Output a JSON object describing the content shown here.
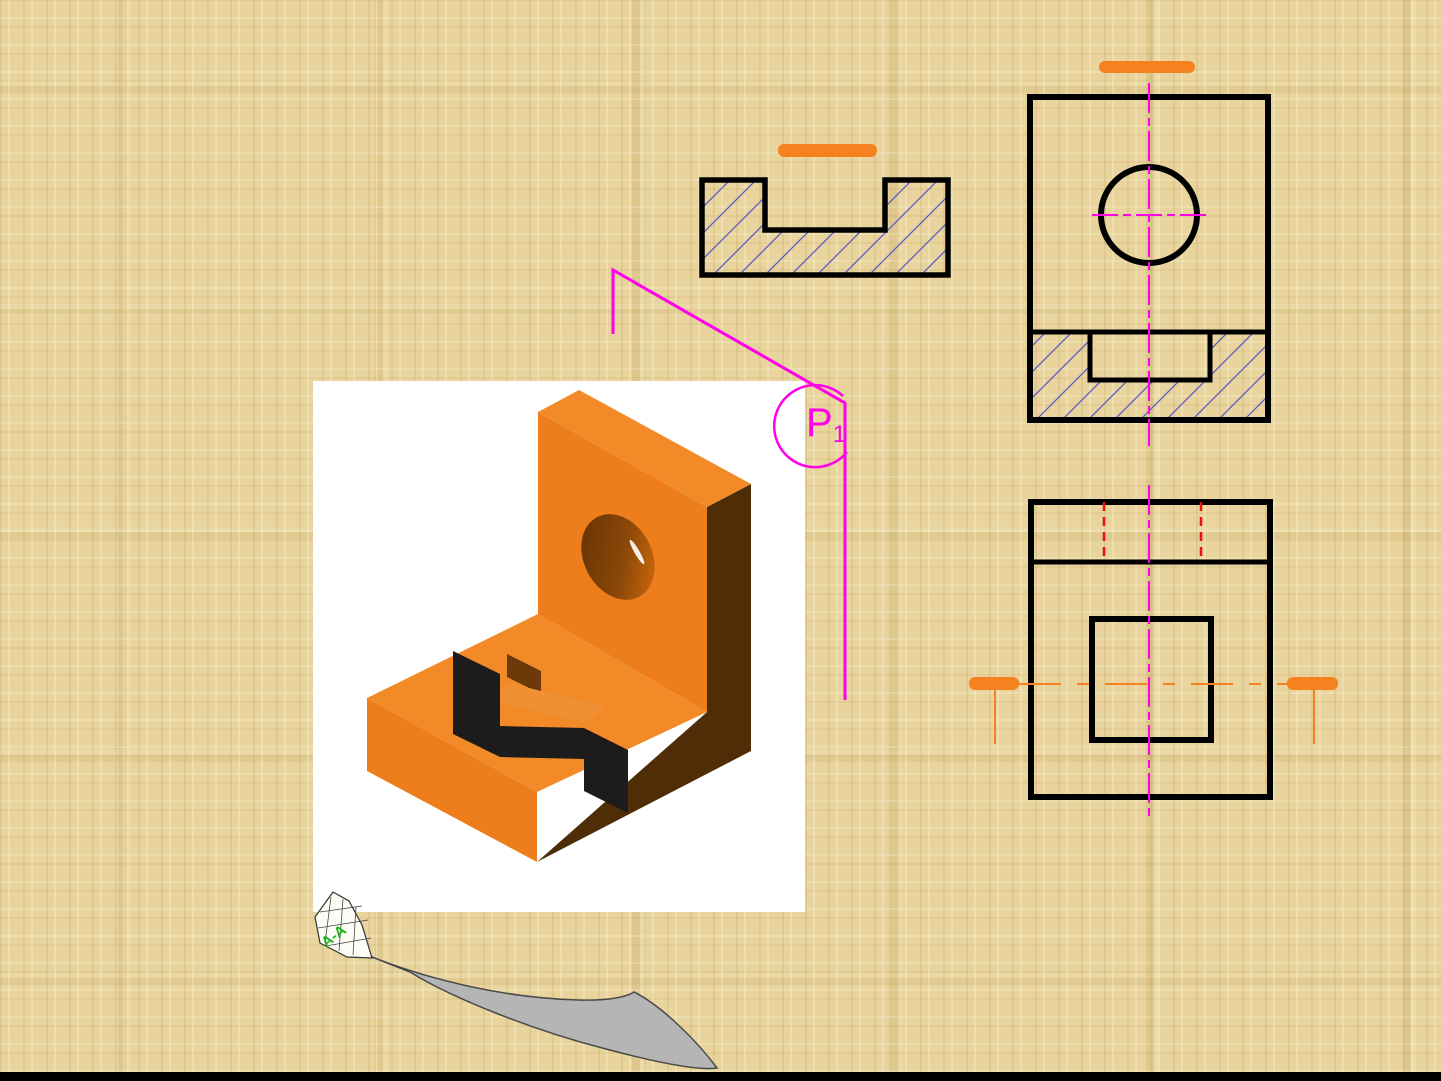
{
  "labels": {
    "cutting_plane_main": "P",
    "cutting_plane_sub": "1",
    "section_arrow_label": "A-A"
  },
  "colors": {
    "background": "#e8d49c",
    "outline": "#000000",
    "hatch": "#5a5ac8",
    "magenta": "#ff00e8",
    "hidden_red": "#ee1111",
    "marker_orange": "#f58220",
    "object_orange": "#ee7e1b",
    "object_orange_top": "#f28a28",
    "object_orange_light": "#f09035",
    "object_dark": "#4f2d06",
    "object_dark_inner": "#6b3a08",
    "cut_black": "#1c1c1c",
    "swoosh_gray": "#b5b5b5",
    "label_green": "#1db31d",
    "panel_white": "#ffffff",
    "bottom_bar": "#000000"
  }
}
